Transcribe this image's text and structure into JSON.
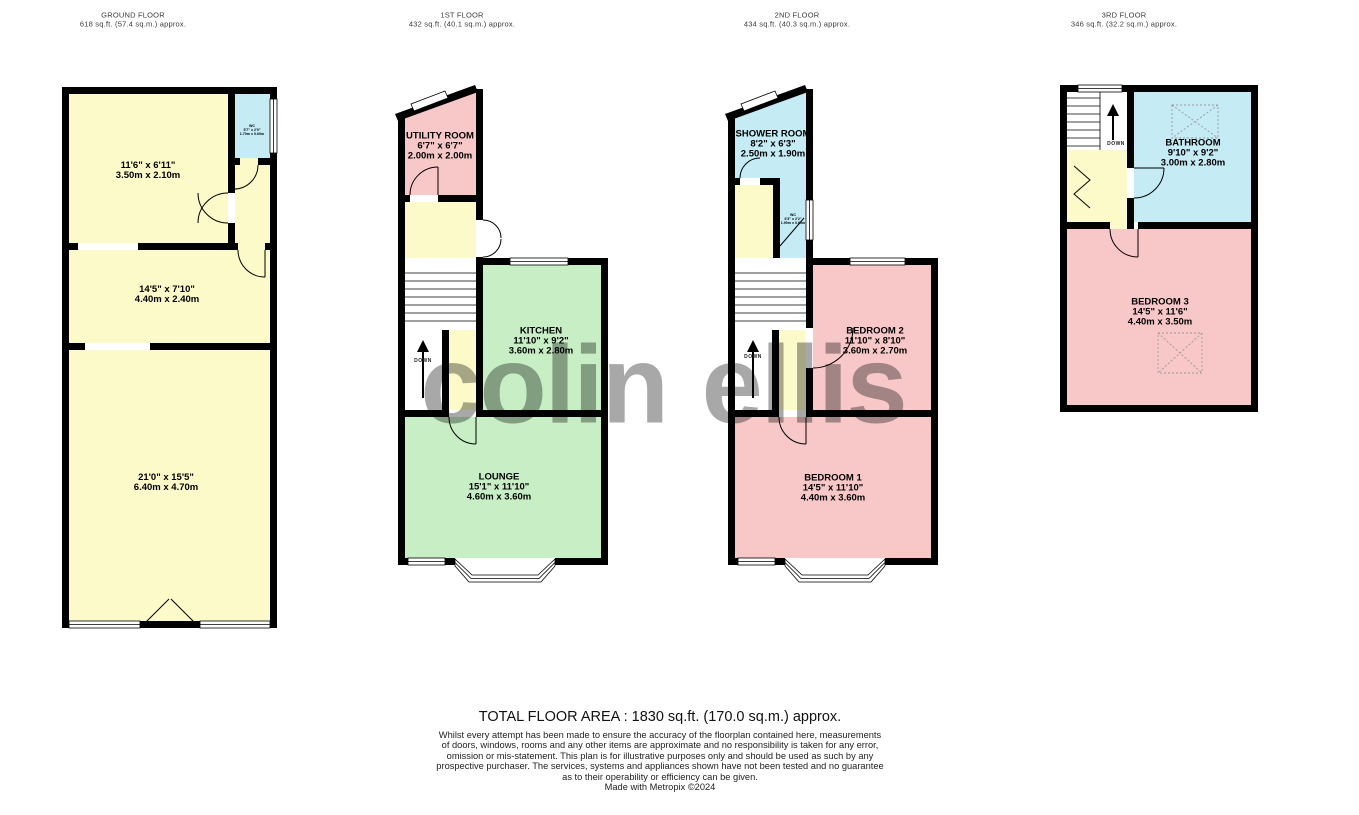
{
  "watermark": "colin ellis",
  "floors": [
    {
      "title": "GROUND FLOOR",
      "area": "618 sq.ft. (57.4 sq.m.) approx.",
      "rooms": [
        {
          "name": "",
          "imperial": "11'6\" x 6'11\"",
          "metric": "3.50m x 2.10m"
        },
        {
          "name": "WC",
          "imperial": "5'7\" x 2'0\"",
          "metric": "1.70m x 0.60m"
        },
        {
          "name": "",
          "imperial": "14'5\" x 7'10\"",
          "metric": "4.40m x 2.40m"
        },
        {
          "name": "",
          "imperial": "21'0\" x 15'5\"",
          "metric": "6.40m x 4.70m"
        }
      ]
    },
    {
      "title": "1ST FLOOR",
      "area": "432 sq.ft. (40.1 sq.m.) approx.",
      "stairs_label": "DOWN",
      "rooms": [
        {
          "name": "UTILITY ROOM",
          "imperial": "6'7\" x 6'7\"",
          "metric": "2.00m x 2.00m"
        },
        {
          "name": "KITCHEN",
          "imperial": "11'10\" x 9'2\"",
          "metric": "3.60m x 2.80m"
        },
        {
          "name": "LOUNGE",
          "imperial": "15'1\" x 11'10\"",
          "metric": "4.60m x 3.60m"
        }
      ]
    },
    {
      "title": "2ND FLOOR",
      "area": "434 sq.ft. (40.3 sq.m.) approx.",
      "stairs_label": "DOWN",
      "rooms": [
        {
          "name": "SHOWER ROOM",
          "imperial": "8'2\" x 6'3\"",
          "metric": "2.50m x 1.90m"
        },
        {
          "name": "WC",
          "imperial": "6'3\" x 2'2\"",
          "metric": "1.90m x 0.65m"
        },
        {
          "name": "BEDROOM 2",
          "imperial": "11'10\" x 8'10\"",
          "metric": "3.60m x 2.70m"
        },
        {
          "name": "BEDROOM 1",
          "imperial": "14'5\" x 11'10\"",
          "metric": "4.40m x 3.60m"
        }
      ]
    },
    {
      "title": "3RD FLOOR",
      "area": "346 sq.ft. (32.2 sq.m.) approx.",
      "stairs_label": "DOWN",
      "rooms": [
        {
          "name": "BATHROOM",
          "imperial": "9'10\" x 9'2\"",
          "metric": "3.00m x 2.80m"
        },
        {
          "name": "BEDROOM 3",
          "imperial": "14'5\" x 11'6\"",
          "metric": "4.40m x 3.50m"
        }
      ]
    }
  ],
  "footer": {
    "total": "TOTAL FLOOR AREA : 1830 sq.ft. (170.0 sq.m.) approx.",
    "disclaimer_lines": [
      "Whilst every attempt has been made to ensure the accuracy of the floorplan contained here, measurements",
      "of doors, windows, rooms and any other items are approximate and no responsibility is taken for any error,",
      "omission or mis-statement. This plan is for illustrative purposes only and should be used as such by any",
      "prospective purchaser. The services, systems and appliances shown have not been tested and no guarantee",
      "as to their operability or efficiency can be given."
    ],
    "credit": "Made with Metropix ©2024"
  },
  "colors": {
    "room_yellow": "#FCFAC8",
    "room_green": "#C7EEC4",
    "room_pink": "#F8C8C8",
    "room_blue": "#C5EBF5",
    "wall": "#000000",
    "watermark": "#A8A8A8"
  }
}
